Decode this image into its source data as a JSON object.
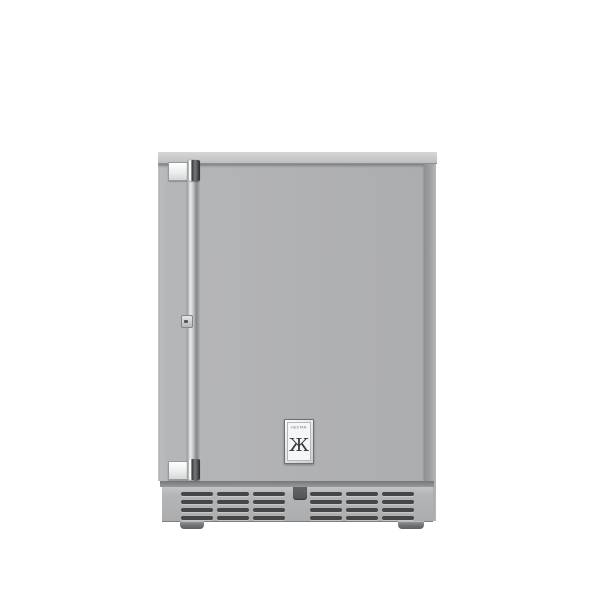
{
  "page": {
    "background": "#ffffff"
  },
  "product": {
    "brand_label": "HESTAN",
    "logo_glyph": "Ж"
  },
  "colors": {
    "cabinet_top": "#c6c7c8",
    "cabinet_top_light": "#d5d6d7",
    "door": "#b1b2b4",
    "side_panel": "#9d9ea0",
    "kick_plate": "#b4b5b6",
    "vent_slot": "#454648",
    "handle_chrome_light": "#eceded",
    "handle_chrome_dark": "#85868a",
    "foot": "#717274",
    "badge_face": "#f5f6f7"
  },
  "vents": {
    "groups": 2,
    "columns_per_group": 3,
    "slots_per_column": 4
  }
}
